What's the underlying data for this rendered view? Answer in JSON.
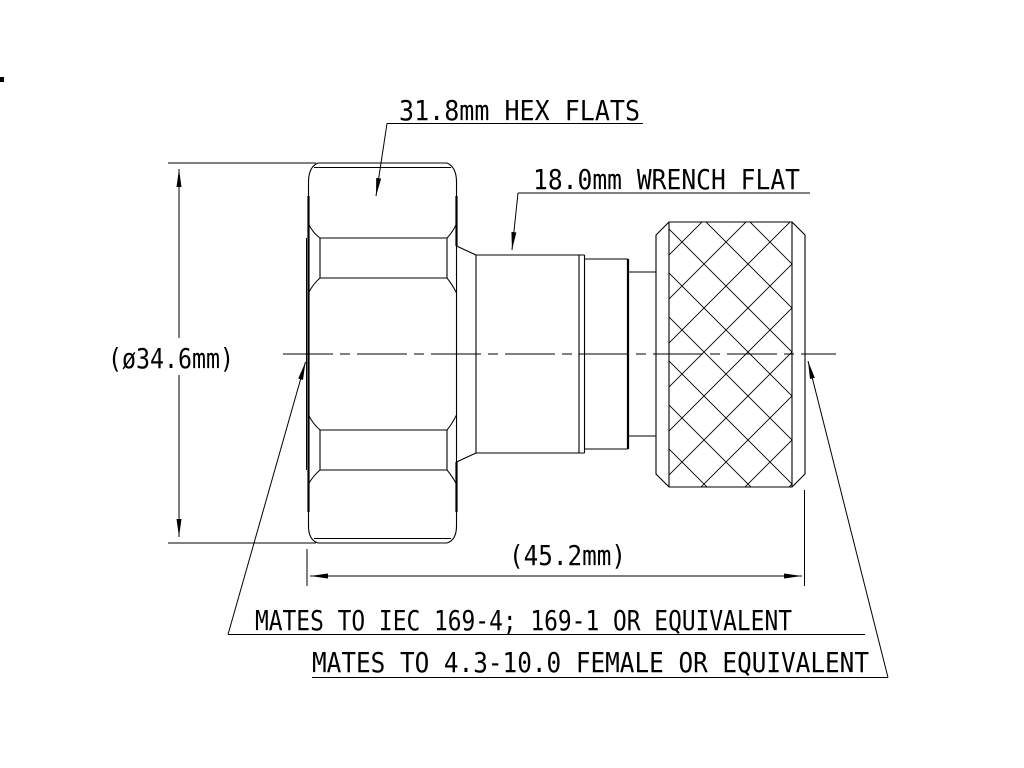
{
  "drawing": {
    "type": "technical-drawing",
    "colors": {
      "background": "#ffffff",
      "line": "#000000"
    },
    "callouts": {
      "hex_flats": "31.8mm HEX FLATS",
      "wrench_flat": "18.0mm WRENCH FLAT"
    },
    "dimensions": {
      "diameter": "(ø34.6mm)",
      "length": "(45.2mm)"
    },
    "notes": {
      "mates_left": "MATES TO IEC 169-4; 169-1 OR EQUIVALENT",
      "mates_right": "MATES TO 4.3-10.0 FEMALE OR EQUIVALENT"
    }
  }
}
